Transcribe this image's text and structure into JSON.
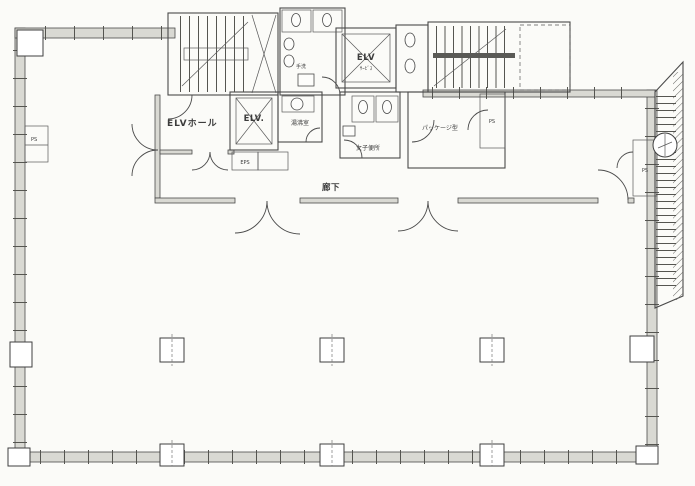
{
  "document": {
    "type": "architectural-floor-plan",
    "style": "scanned pencil drawing",
    "language": "ja"
  },
  "colors": {
    "paper": "#fbfbf8",
    "ink": "#454545",
    "wall_fill": "#d9d9d3"
  },
  "plan": {
    "core": {
      "elv_hall_label": "ELVホール",
      "elevator_passenger_label": "ELV.",
      "elevator_service_label": "ELV",
      "elevator_service_sublabel": "ｻｰﾋﾞｽ",
      "corridor_label": "廊下",
      "kitchenette_label": "湯沸室",
      "womens_toilet_label": "女子便所",
      "hand_wash_label": "手洗",
      "package_unit_room_label": "パッケージ型",
      "eps_label": "EPS"
    },
    "shafts": {
      "ps_left_label": "PS",
      "ps_right_label": "PS",
      "ps_package_label": "PS"
    }
  }
}
